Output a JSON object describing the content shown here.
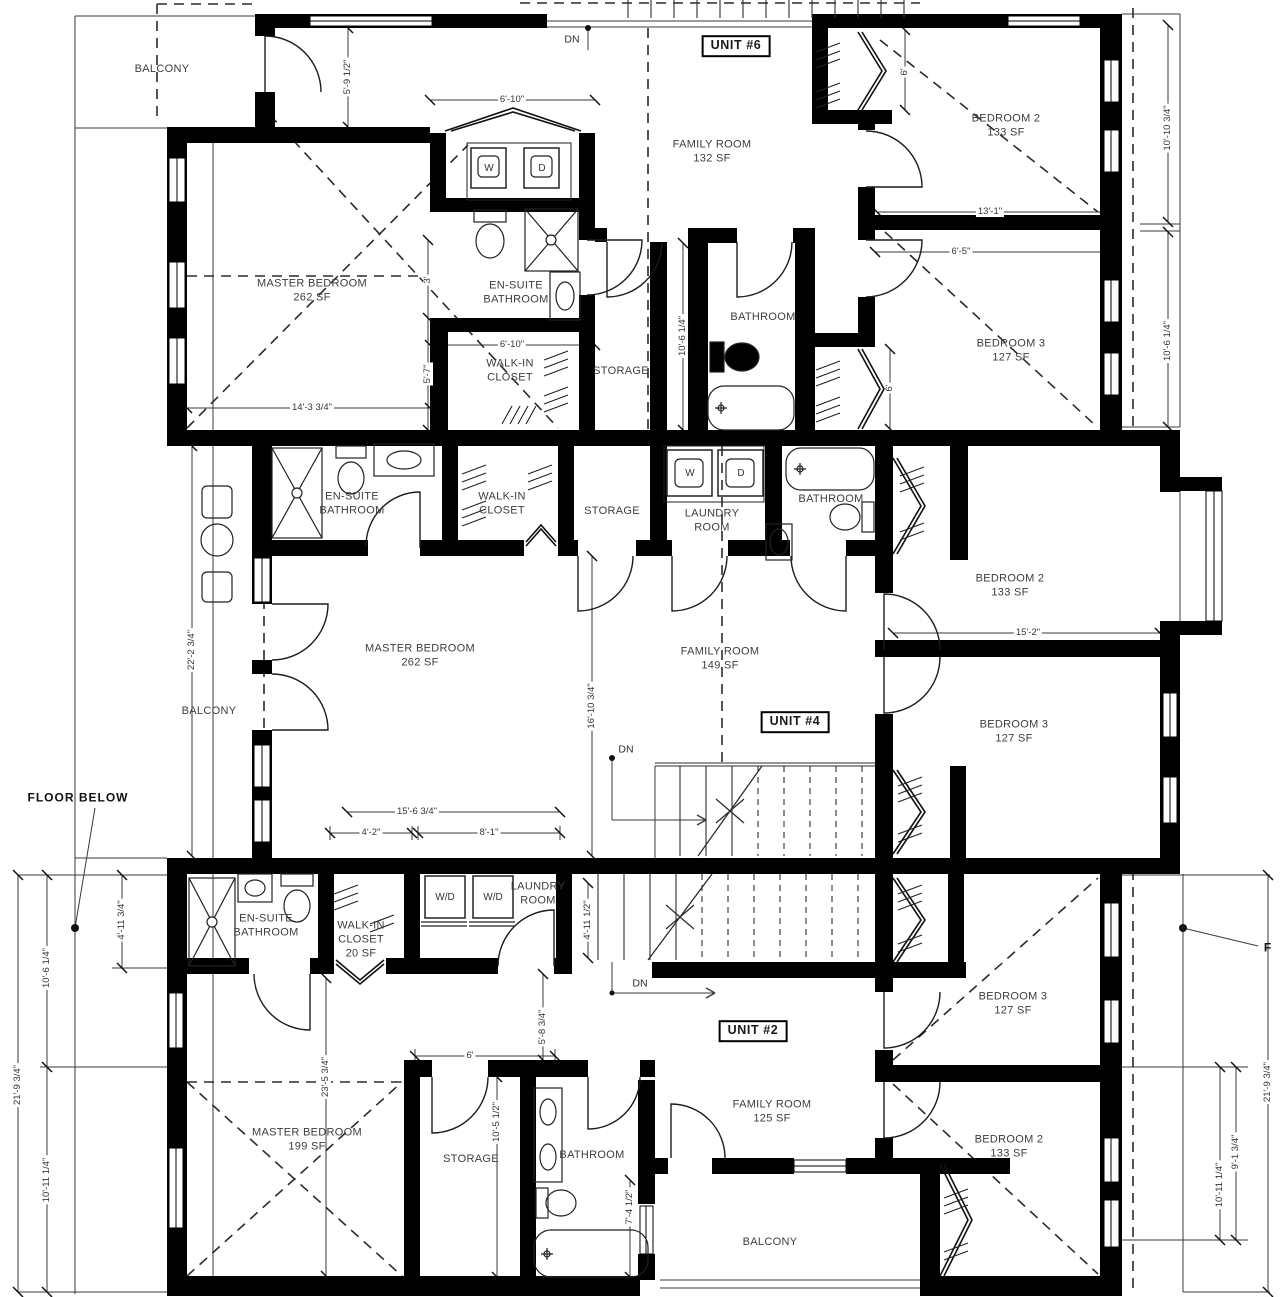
{
  "drawing": {
    "type": "architectural-floor-plan",
    "colors": {
      "wall": "#000000",
      "line": "#2e2e2e",
      "text": "#3d3d3d"
    },
    "unit_labels": [
      {
        "t": "UNIT #6",
        "x": 736,
        "y": 46
      },
      {
        "t": "UNIT #4",
        "x": 795,
        "y": 722
      },
      {
        "t": "UNIT #2",
        "x": 753,
        "y": 1031
      }
    ],
    "room_labels": [
      {
        "t": "BALCONY",
        "x": 162,
        "y": 70
      },
      {
        "t": "MASTER BEDROOM\n262 SF",
        "x": 312,
        "y": 291
      },
      {
        "t": "EN-SUITE\nBATHROOM",
        "x": 516,
        "y": 293
      },
      {
        "t": "WALK-IN\nCLOSET",
        "x": 510,
        "y": 371
      },
      {
        "t": "STORAGE",
        "x": 621,
        "y": 372
      },
      {
        "t": "FAMILY ROOM\n132 SF",
        "x": 712,
        "y": 152
      },
      {
        "t": "BATHROOM",
        "x": 763,
        "y": 318
      },
      {
        "t": "BEDROOM 2\n133 SF",
        "x": 1006,
        "y": 126
      },
      {
        "t": "BEDROOM 3\n127 SF",
        "x": 1011,
        "y": 351
      },
      {
        "t": "EN-SUITE\nBATHROOM",
        "x": 352,
        "y": 504
      },
      {
        "t": "WALK-IN\nCLOSET",
        "x": 502,
        "y": 504
      },
      {
        "t": "STORAGE",
        "x": 612,
        "y": 512
      },
      {
        "t": "LAUNDRY\nROOM",
        "x": 712,
        "y": 521
      },
      {
        "t": "BATHROOM",
        "x": 831,
        "y": 500
      },
      {
        "t": "BEDROOM 2\n133 SF",
        "x": 1010,
        "y": 586
      },
      {
        "t": "MASTER BEDROOM\n262 SF",
        "x": 420,
        "y": 656
      },
      {
        "t": "FAMILY ROOM\n149 SF",
        "x": 720,
        "y": 659
      },
      {
        "t": "BEDROOM 3\n127 SF",
        "x": 1014,
        "y": 732
      },
      {
        "t": "BALCONY",
        "x": 209,
        "y": 712
      },
      {
        "t": "EN-SUITE\nBATHROOM",
        "x": 266,
        "y": 926
      },
      {
        "t": "WALK-IN\nCLOSET\n20 SF",
        "x": 361,
        "y": 940
      },
      {
        "t": "LAUNDRY\nROOM",
        "x": 538,
        "y": 894
      },
      {
        "t": "MASTER BEDROOM\n199 SF",
        "x": 307,
        "y": 1140
      },
      {
        "t": "STORAGE",
        "x": 471,
        "y": 1160
      },
      {
        "t": "BATHROOM",
        "x": 592,
        "y": 1156
      },
      {
        "t": "FAMILY ROOM\n125 SF",
        "x": 772,
        "y": 1112
      },
      {
        "t": "BALCONY",
        "x": 770,
        "y": 1243
      },
      {
        "t": "BEDROOM 3\n127 SF",
        "x": 1013,
        "y": 1004
      },
      {
        "t": "BEDROOM 2\n133 SF",
        "x": 1009,
        "y": 1147
      }
    ],
    "dim_labels": [
      {
        "t": "5'-9 1/2\"",
        "x": 348,
        "y": 77,
        "r": true
      },
      {
        "t": "6'-10\"",
        "x": 512,
        "y": 100
      },
      {
        "t": "6'-10\"",
        "x": 512,
        "y": 345
      },
      {
        "t": "3'",
        "x": 428,
        "y": 280,
        "r": true
      },
      {
        "t": "5'-7\"",
        "x": 428,
        "y": 374,
        "r": true
      },
      {
        "t": "14'-3 3/4\"",
        "x": 312,
        "y": 408
      },
      {
        "t": "10'-6 1/4\"",
        "x": 683,
        "y": 336,
        "r": true
      },
      {
        "t": "6'",
        "x": 905,
        "y": 72,
        "r": true
      },
      {
        "t": "6'",
        "x": 890,
        "y": 388,
        "r": true
      },
      {
        "t": "13'-1\"",
        "x": 990,
        "y": 212
      },
      {
        "t": "6'-5\"",
        "x": 961,
        "y": 252
      },
      {
        "t": "10'-10 3/4\"",
        "x": 1168,
        "y": 128,
        "r": true
      },
      {
        "t": "10'-6 1/4\"",
        "x": 1168,
        "y": 341,
        "r": true
      },
      {
        "t": "22'-2 3/4\"",
        "x": 192,
        "y": 650,
        "r": true
      },
      {
        "t": "16'-10 3/4\"",
        "x": 592,
        "y": 706,
        "r": true
      },
      {
        "t": "15'-2\"",
        "x": 1028,
        "y": 633
      },
      {
        "t": "15'-6 3/4\"",
        "x": 417,
        "y": 812
      },
      {
        "t": "4'-2\"",
        "x": 371,
        "y": 833
      },
      {
        "t": "8'-1\"",
        "x": 489,
        "y": 833
      },
      {
        "t": "4'-11 3/4\"",
        "x": 122,
        "y": 920,
        "r": true
      },
      {
        "t": "10'-6 1/4\"",
        "x": 47,
        "y": 968,
        "r": true
      },
      {
        "t": "21'-9 3/4\"",
        "x": 18,
        "y": 1085,
        "r": true
      },
      {
        "t": "10'-11 1/4\"",
        "x": 47,
        "y": 1180,
        "r": true
      },
      {
        "t": "23'-5 3/4\"",
        "x": 326,
        "y": 1077,
        "r": true
      },
      {
        "t": "4'-11 1/2\"",
        "x": 588,
        "y": 920,
        "r": true
      },
      {
        "t": "5'-8 3/4\"",
        "x": 543,
        "y": 1027,
        "r": true
      },
      {
        "t": "6'",
        "x": 470,
        "y": 1056
      },
      {
        "t": "10'-5 1/2\"",
        "x": 497,
        "y": 1122,
        "r": true
      },
      {
        "t": "7'-4 1/2\"",
        "x": 630,
        "y": 1207,
        "r": true
      },
      {
        "t": "21'-9 3/4\"",
        "x": 1268,
        "y": 1082,
        "r": true
      },
      {
        "t": "10'-11 1/4\"",
        "x": 1220,
        "y": 1185,
        "r": true
      },
      {
        "t": "9'-1 3/4\"",
        "x": 1236,
        "y": 1152,
        "r": true
      }
    ],
    "appliance_labels": [
      {
        "t": "W",
        "x": 489,
        "y": 169
      },
      {
        "t": "D",
        "x": 542,
        "y": 169
      },
      {
        "t": "W",
        "x": 690,
        "y": 474
      },
      {
        "t": "D",
        "x": 741,
        "y": 474
      },
      {
        "t": "W/D",
        "x": 445,
        "y": 898
      },
      {
        "t": "W/D",
        "x": 493,
        "y": 898
      }
    ],
    "annotations": [
      {
        "t": "DN",
        "x": 572,
        "y": 40,
        "c": "note"
      },
      {
        "t": "DN",
        "x": 626,
        "y": 750,
        "c": "note"
      },
      {
        "t": "DN",
        "x": 640,
        "y": 984,
        "c": "note"
      },
      {
        "t": "FLOOR BELOW",
        "x": 78,
        "y": 798,
        "c": "heavy"
      },
      {
        "t": "F",
        "x": 1268,
        "y": 948,
        "c": "heavy"
      }
    ]
  }
}
